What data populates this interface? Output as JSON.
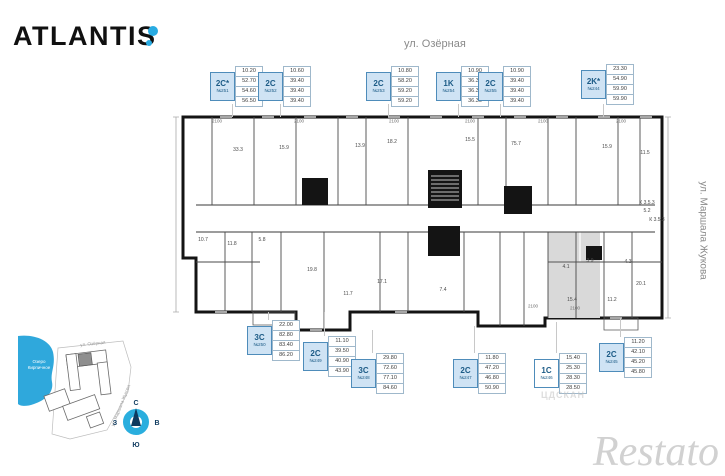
{
  "brand": {
    "logo_text": "ATLANTIS",
    "dot_color": "#29abe2"
  },
  "streets": {
    "top": "ул. Озёрная",
    "right": "ул. Маршала Жукова"
  },
  "units": [
    {
      "type": "2C*",
      "number": "№251",
      "values": [
        "10.20",
        "52.70",
        "54.60",
        "56.50"
      ],
      "x": 210,
      "y": 66,
      "selected": false
    },
    {
      "type": "2C",
      "number": "№252",
      "values": [
        "10.60",
        "39.40",
        "39.40",
        "39.40"
      ],
      "x": 258,
      "y": 66,
      "selected": false
    },
    {
      "type": "2C",
      "number": "№253",
      "values": [
        "10.80",
        "58.20",
        "59.20",
        "59.20"
      ],
      "x": 366,
      "y": 66,
      "selected": false
    },
    {
      "type": "1K",
      "number": "№254",
      "values": [
        "10.90",
        "36.30",
        "36.30",
        "36.30"
      ],
      "x": 436,
      "y": 66,
      "selected": false
    },
    {
      "type": "2C",
      "number": "№255",
      "values": [
        "10.90",
        "39.40",
        "39.40",
        "39.40"
      ],
      "x": 478,
      "y": 66,
      "selected": false
    },
    {
      "type": "2K*",
      "number": "№244",
      "values": [
        "23.30",
        "54.90",
        "59.90",
        "59.90"
      ],
      "x": 581,
      "y": 64,
      "selected": false
    },
    {
      "type": "3C",
      "number": "№250",
      "values": [
        "22.00",
        "82.80",
        "83.40",
        "86.20"
      ],
      "x": 247,
      "y": 320,
      "selected": false
    },
    {
      "type": "2C",
      "number": "№249",
      "values": [
        "11.10",
        "39.50",
        "40.90",
        "43.90"
      ],
      "x": 303,
      "y": 336,
      "selected": false
    },
    {
      "type": "3C",
      "number": "№248",
      "values": [
        "29.80",
        "72.60",
        "77.10",
        "84.60"
      ],
      "x": 351,
      "y": 353,
      "selected": false
    },
    {
      "type": "2C",
      "number": "№247",
      "values": [
        "11.80",
        "47.20",
        "46.80",
        "50.90"
      ],
      "x": 453,
      "y": 353,
      "selected": false
    },
    {
      "type": "1C",
      "number": "№246",
      "values": [
        "15.40",
        "25.30",
        "28.30",
        "28.50"
      ],
      "x": 534,
      "y": 353,
      "selected": true
    },
    {
      "type": "2C",
      "number": "№245",
      "values": [
        "11.20",
        "42.10",
        "45.20",
        "45.80"
      ],
      "x": 599,
      "y": 337,
      "selected": false
    }
  ],
  "plan": {
    "room_labels": [
      {
        "t": "33.3",
        "x": 238,
        "y": 150
      },
      {
        "t": "15.9",
        "x": 284,
        "y": 148
      },
      {
        "t": "13.9",
        "x": 360,
        "y": 146
      },
      {
        "t": "18.2",
        "x": 392,
        "y": 142
      },
      {
        "t": "15.5",
        "x": 470,
        "y": 140
      },
      {
        "t": "75.7",
        "x": 516,
        "y": 144
      },
      {
        "t": "15.9",
        "x": 607,
        "y": 147
      },
      {
        "t": "11.5",
        "x": 645,
        "y": 153
      },
      {
        "t": "10.7",
        "x": 203,
        "y": 240
      },
      {
        "t": "11.8",
        "x": 232,
        "y": 244
      },
      {
        "t": "5.8",
        "x": 262,
        "y": 240
      },
      {
        "t": "19.8",
        "x": 312,
        "y": 270
      },
      {
        "t": "11.7",
        "x": 348,
        "y": 294
      },
      {
        "t": "17.1",
        "x": 382,
        "y": 282
      },
      {
        "t": "7.4",
        "x": 443,
        "y": 290
      },
      {
        "t": "4.1",
        "x": 566,
        "y": 267
      },
      {
        "t": "3.9",
        "x": 590,
        "y": 261
      },
      {
        "t": "15.4",
        "x": 572,
        "y": 300
      },
      {
        "t": "4.3",
        "x": 628,
        "y": 262
      },
      {
        "t": "20.1",
        "x": 641,
        "y": 284
      },
      {
        "t": "11.2",
        "x": 612,
        "y": 300
      },
      {
        "t": "К 3.5.3",
        "x": 647,
        "y": 203
      },
      {
        "t": "5.2",
        "x": 647,
        "y": 211
      },
      {
        "t": "К 3.5.3",
        "x": 657,
        "y": 220
      }
    ],
    "dimension_labels": [
      {
        "t": "2100",
        "x": 217,
        "y": 121
      },
      {
        "t": "2100",
        "x": 299,
        "y": 121
      },
      {
        "t": "2100",
        "x": 394,
        "y": 121
      },
      {
        "t": "2100",
        "x": 470,
        "y": 121
      },
      {
        "t": "2100",
        "x": 543,
        "y": 121
      },
      {
        "t": "2100",
        "x": 621,
        "y": 121
      },
      {
        "t": "2100",
        "x": 533,
        "y": 306
      },
      {
        "t": "2100",
        "x": 575,
        "y": 308
      }
    ],
    "leaders": [
      {
        "x": 232,
        "y1": 104,
        "y2": 117
      },
      {
        "x": 280,
        "y1": 104,
        "y2": 117
      },
      {
        "x": 388,
        "y1": 104,
        "y2": 117
      },
      {
        "x": 458,
        "y1": 104,
        "y2": 117
      },
      {
        "x": 500,
        "y1": 104,
        "y2": 117
      },
      {
        "x": 603,
        "y1": 104,
        "y2": 117
      },
      {
        "x": 268,
        "y1": 312,
        "y2": 320
      },
      {
        "x": 324,
        "y1": 312,
        "y2": 336
      },
      {
        "x": 372,
        "y1": 330,
        "y2": 353
      },
      {
        "x": 474,
        "y1": 326,
        "y2": 353
      },
      {
        "x": 556,
        "y1": 322,
        "y2": 353
      },
      {
        "x": 620,
        "y1": 318,
        "y2": 337
      }
    ]
  },
  "site_plan": {
    "lake_label_line1": "Озеро",
    "lake_label_line2": "Кирпичное",
    "street_top": "ул. Озёрная",
    "street_right": "ул. Маршала Жукова",
    "compass": {
      "north": "С",
      "east": "В",
      "west": "З",
      "south": "Ю"
    }
  },
  "watermarks": {
    "main": "Restato",
    "small": "ЦДСКАН"
  },
  "colors": {
    "accent_blue": "#29abe2",
    "card_fill": "#cfe3f4",
    "card_border": "#4e8cba",
    "wall": "#141414",
    "highlight_unit": "#d9d9d9",
    "lake": "#2fa8dc"
  }
}
